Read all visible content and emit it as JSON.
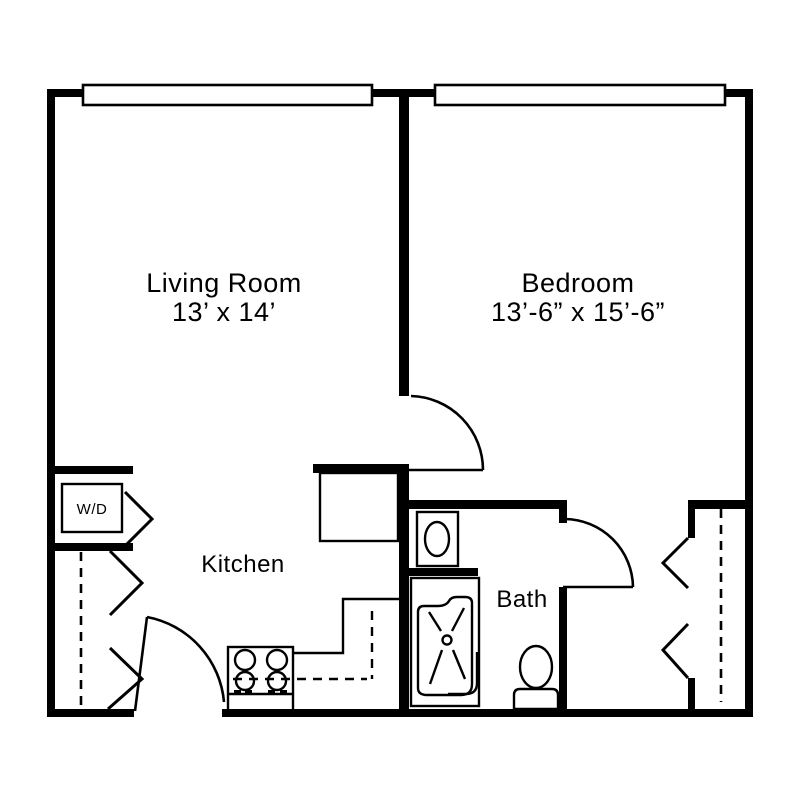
{
  "page": {
    "background": "#ffffff",
    "line_color": "#000000"
  },
  "rooms": {
    "living_room": {
      "name": "Living Room",
      "dimensions": "13’ x 14’"
    },
    "bedroom": {
      "name": "Bedroom",
      "dimensions": "13’-6” x 15’-6”"
    },
    "kitchen": {
      "name": "Kitchen"
    },
    "bath": {
      "name": "Bath"
    },
    "laundry": {
      "label": "W/D"
    }
  },
  "fixtures": [
    "washer-dryer",
    "stove-cooktop",
    "refrigerator",
    "kitchen-counter",
    "upper-cabinets-dashed",
    "bathroom-sink",
    "bathtub-shower",
    "toilet"
  ],
  "features": {
    "windows": 2,
    "doors": [
      "entry-door",
      "bedroom-door",
      "bath-door"
    ],
    "closets": [
      "entry-closet",
      "wd-closet",
      "bedroom-closet"
    ]
  }
}
